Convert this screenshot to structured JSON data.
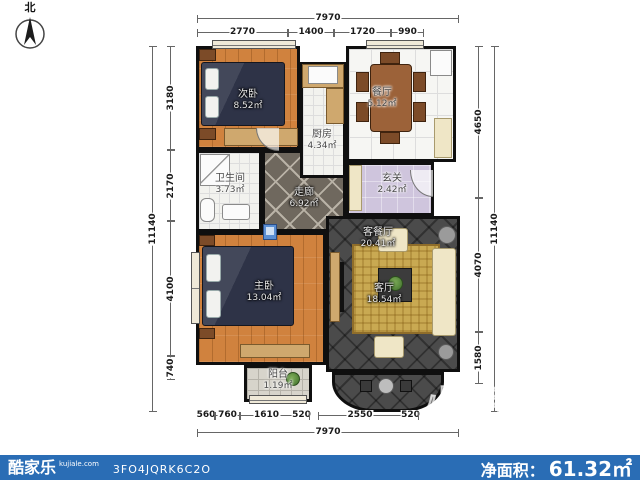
{
  "compass": {
    "north_label": "北"
  },
  "dimensions": {
    "top_total": "7970",
    "top_segments": [
      "2770",
      "1400",
      "1720",
      "990"
    ],
    "left_total": "11140",
    "left_segments": [
      "3180",
      "2170",
      "4100",
      "740"
    ],
    "right_total": "11140",
    "right_segments": [
      "4650",
      "4070",
      "1580"
    ],
    "bottom_total": "7970",
    "bottom_segments": [
      "560",
      "760",
      "1610",
      "520",
      "2550",
      "520"
    ]
  },
  "rooms": [
    {
      "label": "次卧",
      "area": "8.52㎡"
    },
    {
      "label": "厨房",
      "area": "4.34㎡"
    },
    {
      "label": "餐厅",
      "area": "5.12㎡"
    },
    {
      "label": "玄关",
      "area": "2.42㎡"
    },
    {
      "label": "卫生间",
      "area": "3.73㎡"
    },
    {
      "label": "走廊",
      "area": "6.92㎡"
    },
    {
      "label": "客餐厅",
      "area": "20.41㎡"
    },
    {
      "label": "客厅",
      "area": "18.54㎡"
    },
    {
      "label": "主卧",
      "area": "13.04㎡"
    },
    {
      "label": "阳台",
      "area": "1.19㎡"
    }
  ],
  "watermark": {
    "text": "小尼宅配"
  },
  "footer": {
    "brand": "酷家乐",
    "brand_site": "kujiale.com",
    "plan_code": "3FO4JQRK6C2O",
    "net_area_label": "净面积：",
    "net_area_value": "61.32㎡",
    "bar_color": "#2a6db5"
  }
}
